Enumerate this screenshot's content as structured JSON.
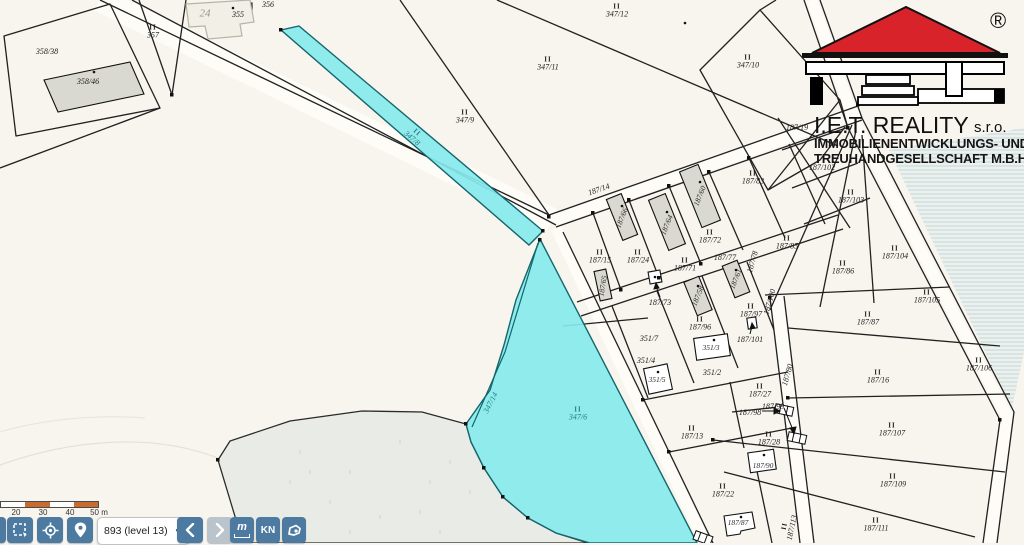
{
  "logo": {
    "registered": "®",
    "title": "I.E.T. REALITY",
    "suffix": "s.r.o.",
    "line2": "IMMOBILIENENTWICKLUNGS- UND",
    "line3": "TREUHANDGESELLSCHAFT M.B.H."
  },
  "toolbar": {
    "zoom_select_value": "893 (level 13)",
    "measure_label": "m",
    "kn_label": "KN"
  },
  "scale": {
    "labels": [
      "20",
      "30",
      "40",
      "50 m"
    ]
  },
  "colors": {
    "highlight_fill": "#86e9ec",
    "highlight_stroke": "#15666d",
    "toolbar_button": "#4c7aa0",
    "toolbar_button_disabled": "#b9c4cc",
    "scale_orange": "#c96a2e",
    "logo_red": "#d8232a",
    "parcel_line": "#212121"
  },
  "map": {
    "labels": [
      {
        "t": "358/38",
        "x": 47,
        "y": 52
      },
      {
        "t": "358/46",
        "x": 88,
        "y": 82
      },
      {
        "t": "357",
        "x": 153,
        "y": 32,
        "ii": 1
      },
      {
        "t": "24",
        "x": 205,
        "y": 14,
        "cls": "muted"
      },
      {
        "t": "355",
        "x": 238,
        "y": 15
      },
      {
        "t": "356",
        "x": 268,
        "y": 5
      },
      {
        "t": "347/12",
        "x": 617,
        "y": 11,
        "ii": 1
      },
      {
        "t": "347/11",
        "x": 548,
        "y": 64,
        "ii": 1
      },
      {
        "t": "347/9",
        "x": 465,
        "y": 117,
        "ii": 1
      },
      {
        "t": "347/10",
        "x": 748,
        "y": 62,
        "ii": 1
      },
      {
        "t": "347/8",
        "x": 414,
        "y": 136,
        "rot": 41,
        "ii": 1,
        "cls": "teal"
      },
      {
        "t": "347/14",
        "x": 491,
        "y": 403,
        "rot": -63,
        "cls": "teal"
      },
      {
        "t": "347/6",
        "x": 578,
        "y": 414,
        "ii": 1,
        "cls": "teal"
      },
      {
        "t": "187/14",
        "x": 599,
        "y": 190,
        "rot": -19
      },
      {
        "t": "187/19",
        "x": 797,
        "y": 128
      },
      {
        "t": "187/102",
        "x": 822,
        "y": 168
      },
      {
        "t": "187/103",
        "x": 851,
        "y": 197,
        "ii": 1
      },
      {
        "t": "187/66",
        "x": 622,
        "y": 218,
        "rot": -68,
        "cls": "b"
      },
      {
        "t": "187/64",
        "x": 667,
        "y": 225,
        "rot": -68,
        "cls": "b"
      },
      {
        "t": "187/60",
        "x": 700,
        "y": 196,
        "rot": -68,
        "cls": "b"
      },
      {
        "t": "187/58",
        "x": 698,
        "y": 296,
        "rot": -68,
        "cls": "b"
      },
      {
        "t": "187/61",
        "x": 736,
        "y": 279,
        "rot": -68,
        "cls": "b"
      },
      {
        "t": "187/65",
        "x": 603,
        "y": 286,
        "rot": -80,
        "cls": "b"
      },
      {
        "t": "187/15",
        "x": 600,
        "y": 257,
        "ii": 1
      },
      {
        "t": "187/24",
        "x": 638,
        "y": 257,
        "ii": 1
      },
      {
        "t": "187/71",
        "x": 685,
        "y": 265,
        "ii": 1
      },
      {
        "t": "187/72",
        "x": 710,
        "y": 237,
        "ii": 1
      },
      {
        "t": "187/83",
        "x": 753,
        "y": 178,
        "ii": 1
      },
      {
        "t": "187/77",
        "x": 725,
        "y": 258
      },
      {
        "t": "187/78",
        "x": 753,
        "y": 262,
        "rot": -74
      },
      {
        "t": "187/100",
        "x": 770,
        "y": 302,
        "rot": -74
      },
      {
        "t": "187/80",
        "x": 788,
        "y": 375,
        "rot": -74
      },
      {
        "t": "187/85",
        "x": 787,
        "y": 243,
        "ii": 1
      },
      {
        "t": "187/86",
        "x": 843,
        "y": 268,
        "ii": 1
      },
      {
        "t": "187/104",
        "x": 895,
        "y": 253,
        "ii": 1
      },
      {
        "t": "187/105",
        "x": 927,
        "y": 297,
        "ii": 1
      },
      {
        "t": "187/87",
        "x": 868,
        "y": 319,
        "ii": 1
      },
      {
        "t": "187/16",
        "x": 878,
        "y": 377,
        "ii": 1
      },
      {
        "t": "187/106",
        "x": 979,
        "y": 365,
        "ii": 1
      },
      {
        "t": "187/107",
        "x": 892,
        "y": 430,
        "ii": 1
      },
      {
        "t": "187/109",
        "x": 893,
        "y": 481,
        "ii": 1
      },
      {
        "t": "187/111",
        "x": 876,
        "y": 525,
        "ii": 1
      },
      {
        "t": "187/96",
        "x": 700,
        "y": 324,
        "ii": 1
      },
      {
        "t": "187/97",
        "x": 751,
        "y": 311,
        "ii": 1
      },
      {
        "t": "187/101",
        "x": 750,
        "y": 340
      },
      {
        "t": "187/73",
        "x": 660,
        "y": 303
      },
      {
        "t": "351/7",
        "x": 649,
        "y": 339
      },
      {
        "t": "351/3",
        "x": 711,
        "y": 348,
        "cls": "b"
      },
      {
        "t": "351/4",
        "x": 646,
        "y": 361
      },
      {
        "t": "351/5",
        "x": 657,
        "y": 380,
        "cls": "b"
      },
      {
        "t": "351/2",
        "x": 712,
        "y": 373
      },
      {
        "t": "187/27",
        "x": 760,
        "y": 391,
        "ii": 1
      },
      {
        "t": "187/99",
        "x": 773,
        "y": 407
      },
      {
        "t": "187/98",
        "x": 750,
        "y": 413
      },
      {
        "t": "187/13",
        "x": 692,
        "y": 433,
        "ii": 1
      },
      {
        "t": "187/28",
        "x": 769,
        "y": 439,
        "ii": 1
      },
      {
        "t": "187/90",
        "x": 763,
        "y": 466,
        "cls": "b"
      },
      {
        "t": "187/22",
        "x": 723,
        "y": 491,
        "ii": 1
      },
      {
        "t": "187/87",
        "x": 738,
        "y": 523,
        "cls": "b"
      },
      {
        "t": "187/113",
        "x": 789,
        "y": 527,
        "rot": -78,
        "ii": 1
      }
    ]
  }
}
